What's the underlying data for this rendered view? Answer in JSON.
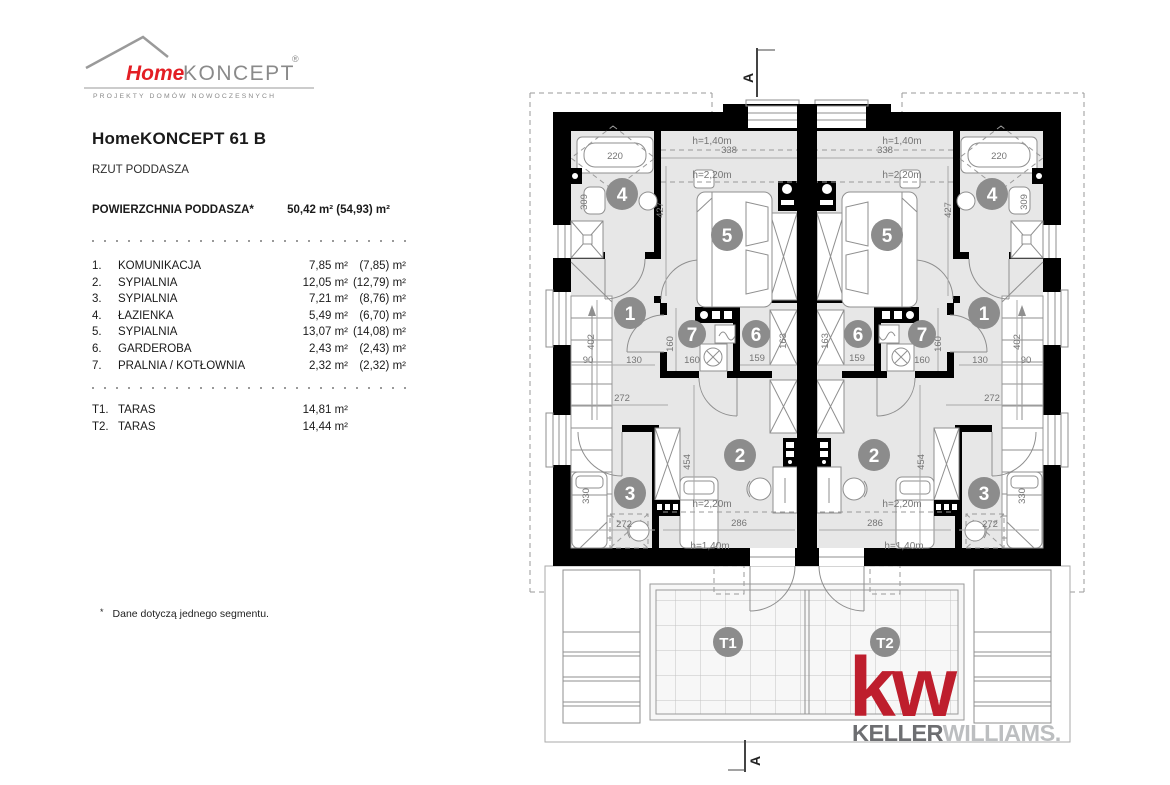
{
  "brand": {
    "home": "Home",
    "koncept": "KONCEPT",
    "reg": "®",
    "tagline": "PROJEKTY DOMÓW NOWOCZESNYCH"
  },
  "header": {
    "title": "HomeKONCEPT 61 B",
    "subtitle": "RZUT PODDASZA"
  },
  "summary": {
    "label": "POWIERZCHNIA PODDASZA*",
    "value": "50,42 m² (54,93) m²"
  },
  "rooms": [
    {
      "no": "1.",
      "name": "KOMUNIKACJA",
      "area": "7,85 m²",
      "area_total": "(7,85) m²"
    },
    {
      "no": "2.",
      "name": "SYPIALNIA",
      "area": "12,05 m²",
      "area_total": "(12,79) m²"
    },
    {
      "no": "3.",
      "name": "SYPIALNIA",
      "area": "7,21 m²",
      "area_total": "(8,76) m²"
    },
    {
      "no": "4.",
      "name": "ŁAZIENKA",
      "area": "5,49 m²",
      "area_total": "(6,70) m²"
    },
    {
      "no": "5.",
      "name": "SYPIALNIA",
      "area": "13,07 m²",
      "area_total": "(14,08) m²"
    },
    {
      "no": "6.",
      "name": "GARDEROBA",
      "area": "2,43 m²",
      "area_total": "(2,43) m²"
    },
    {
      "no": "7.",
      "name": "PRALNIA / KOTŁOWNIA",
      "area": "2,32 m²",
      "area_total": "(2,32) m²"
    }
  ],
  "terraces": [
    {
      "no": "T1.",
      "name": "TARAS",
      "area": "14,81 m²"
    },
    {
      "no": "T2.",
      "name": "TARAS",
      "area": "14,44 m²"
    }
  ],
  "footnote": {
    "mark": "*",
    "text": "Dane dotyczą jednego segmentu."
  },
  "plan": {
    "section_marker": "A",
    "room_numbers": {
      "n1": "1",
      "n2": "2",
      "n3": "3",
      "n4": "4",
      "n5": "5",
      "n6": "6",
      "n7": "7",
      "t1": "T1",
      "t2": "T2"
    },
    "dims": {
      "d90": "90",
      "d130": "130",
      "d159": "159",
      "d160": "160",
      "d163": "163",
      "d220": "220",
      "d272": "272",
      "d286": "286",
      "d309": "309",
      "d330": "330",
      "d338": "338",
      "d402": "402",
      "d427": "427",
      "d454": "454"
    },
    "heights": {
      "h140": "h=1,40m",
      "h220": "h=2,20m"
    }
  },
  "kw": {
    "mark": "kw",
    "keller": "KELLER",
    "williams": "WILLIAMS",
    "dot": "."
  },
  "colors": {
    "brand_red": "#e31e24",
    "kw_red": "#be1e2d",
    "keller_gray": "#6d6e71",
    "williams_gray": "#bcbec0",
    "wall_black": "#000000",
    "room_fill": "#e7e7e7",
    "line_gray": "#8f8f8f",
    "dim_text": "#757575",
    "circle_gray": "#8c8c8c"
  }
}
